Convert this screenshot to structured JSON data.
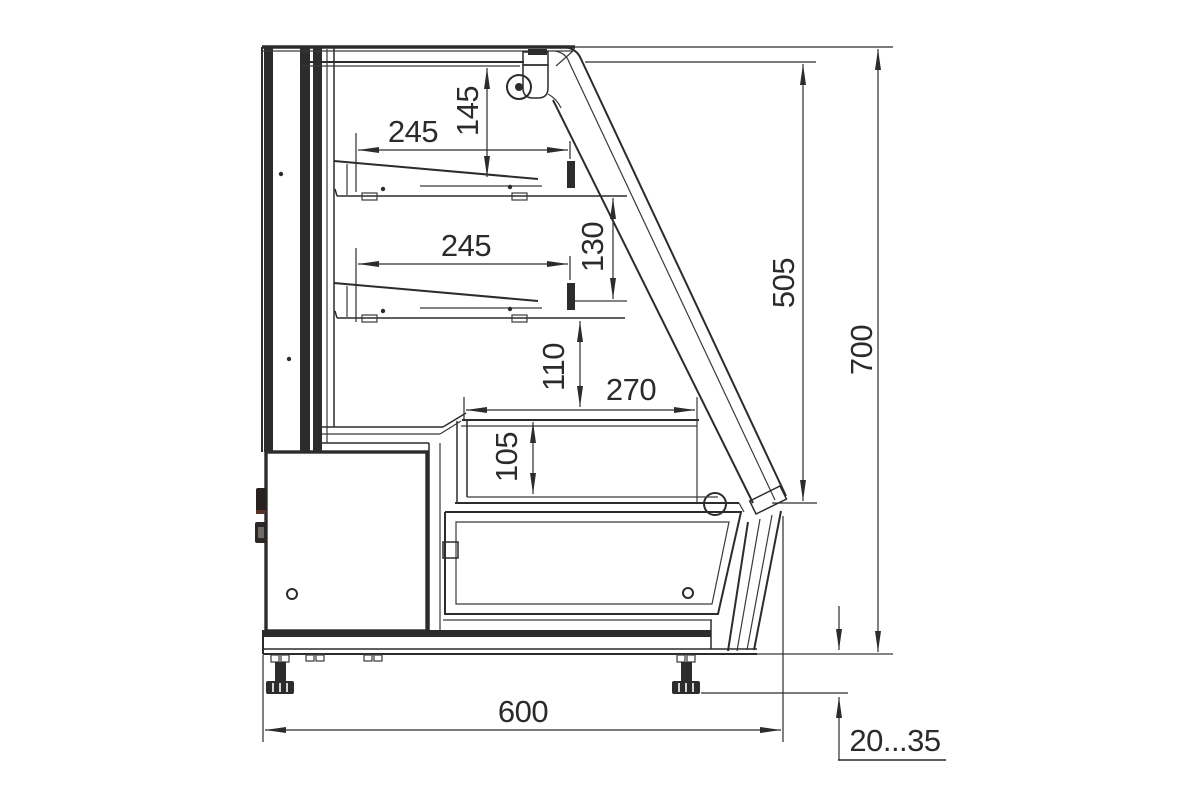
{
  "dimensions": {
    "top_shelf_width": "245",
    "top_shelf_front_height": "145",
    "lower_shelf_width": "245",
    "shelf_spacing": "130",
    "well_clearance": "110",
    "well_width": "270",
    "well_depth": "105",
    "front_glass_height": "505",
    "overall_height": "700",
    "overall_depth": "600",
    "foot_adjustment_range": "20...35"
  },
  "colors": {
    "line": "#2c2c2c",
    "background": "#ffffff"
  }
}
